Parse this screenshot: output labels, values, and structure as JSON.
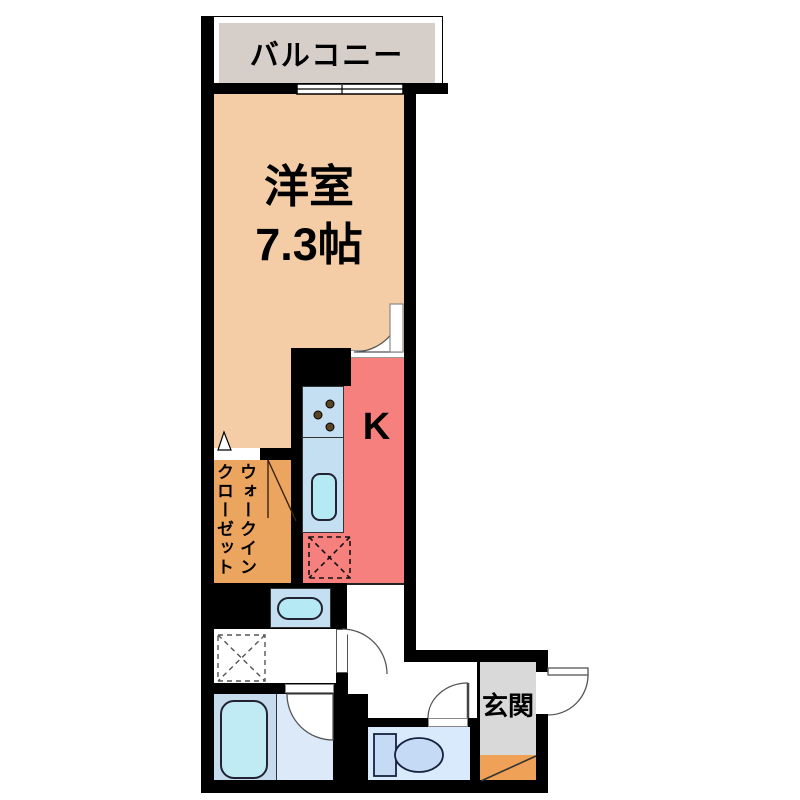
{
  "floor_plan": {
    "balcony": {
      "label": "バルコニー"
    },
    "living_room": {
      "label": "洋室",
      "size": "7.3帖"
    },
    "kitchen": {
      "label": "K"
    },
    "walk_in_closet": {
      "label_column_right": "ウォークイン",
      "label_column_left": "クローゼット"
    },
    "entrance": {
      "label": "玄関"
    },
    "fixtures": {
      "kitchen_counter": "counter-with-stove-and-sink",
      "stove_burners": "three-burner-dots",
      "refrigerator_space": "dashed-x-box",
      "wash_basin": "basin-with-bowl",
      "washing_machine_space": "dashed-x-box",
      "bathtub": "rounded-bathtub",
      "toilet": "tank-and-bowl",
      "entrance_step": "diagonal-step",
      "window": "sliding-window",
      "doors": "swing-arc-doors"
    },
    "colors": {
      "wall": "#000000",
      "living_room": "#f4cda7",
      "kitchen": "#f5807d",
      "walk_in_closet": "#eca55e",
      "balcony": "#d6cfc9",
      "entrance": "#d9d9d9",
      "entrance_step": "#efa257",
      "counter_blue": "#c4def2",
      "sink_cyan": "#b5eaf4",
      "bathroom_left": "#c6dcee",
      "bathroom_right": "#dbe9f8",
      "toilet_room": "#d9eafc",
      "toilet_fixture": "#c5daf4"
    }
  }
}
